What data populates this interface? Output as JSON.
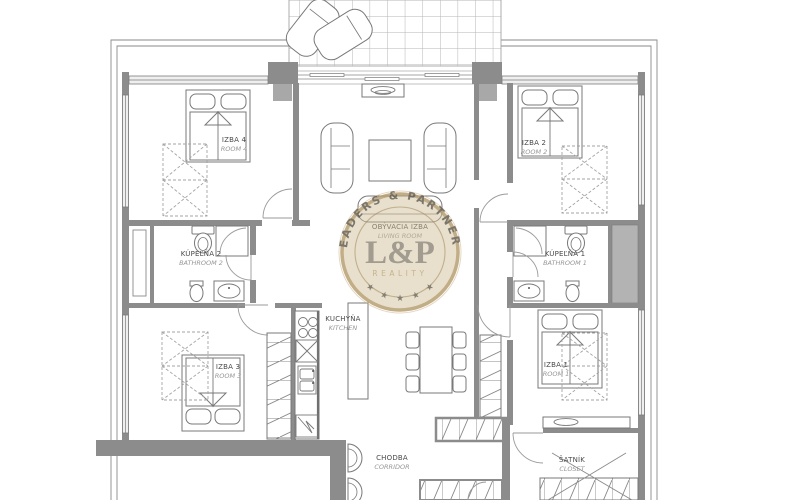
{
  "plan": {
    "title": "apartment-floor-plan",
    "rooms": {
      "room4": {
        "name": "IZBA 4",
        "name_en": "ROOM 4"
      },
      "room2": {
        "name": "IZBA 2",
        "name_en": "ROOM 2"
      },
      "living": {
        "name": "OBÝVACIA IZBA",
        "name_en": "LIVING ROOM"
      },
      "bathroom2": {
        "name": "KÚPEĽŇA 2",
        "name_en": "BATHROOM 2"
      },
      "bathroom1": {
        "name": "KÚPEĽŇA 1",
        "name_en": "BATHROOM 1"
      },
      "kitchen": {
        "name": "KUCHYŇA",
        "name_en": "KITCHEN"
      },
      "room3": {
        "name": "IZBA 3",
        "name_en": "ROOM 3"
      },
      "room1": {
        "name": "IZBA 1",
        "name_en": "ROOM 1"
      },
      "corridor": {
        "name": "CHODBA",
        "name_en": "CORRIDOR"
      },
      "closet": {
        "name": "ŠATNÍK",
        "name_en": "CLOSET"
      }
    }
  },
  "watermark": {
    "arc_text": "LEADERS & PARTNERS",
    "monogram": "L&P",
    "subtitle": "REALITY",
    "star": "★",
    "badge_color": "#cfbc93",
    "ring_color": "#b49c6c",
    "text_color": "#5f584c",
    "monogram_color": "#8d8678",
    "subtitle_color": "#b9a472"
  },
  "colors": {
    "wall": "#8c8c8c",
    "line": "#787878",
    "window_fill": "#efefef",
    "shaft_fill": "#b3b3b3",
    "background": "#ffffff"
  }
}
